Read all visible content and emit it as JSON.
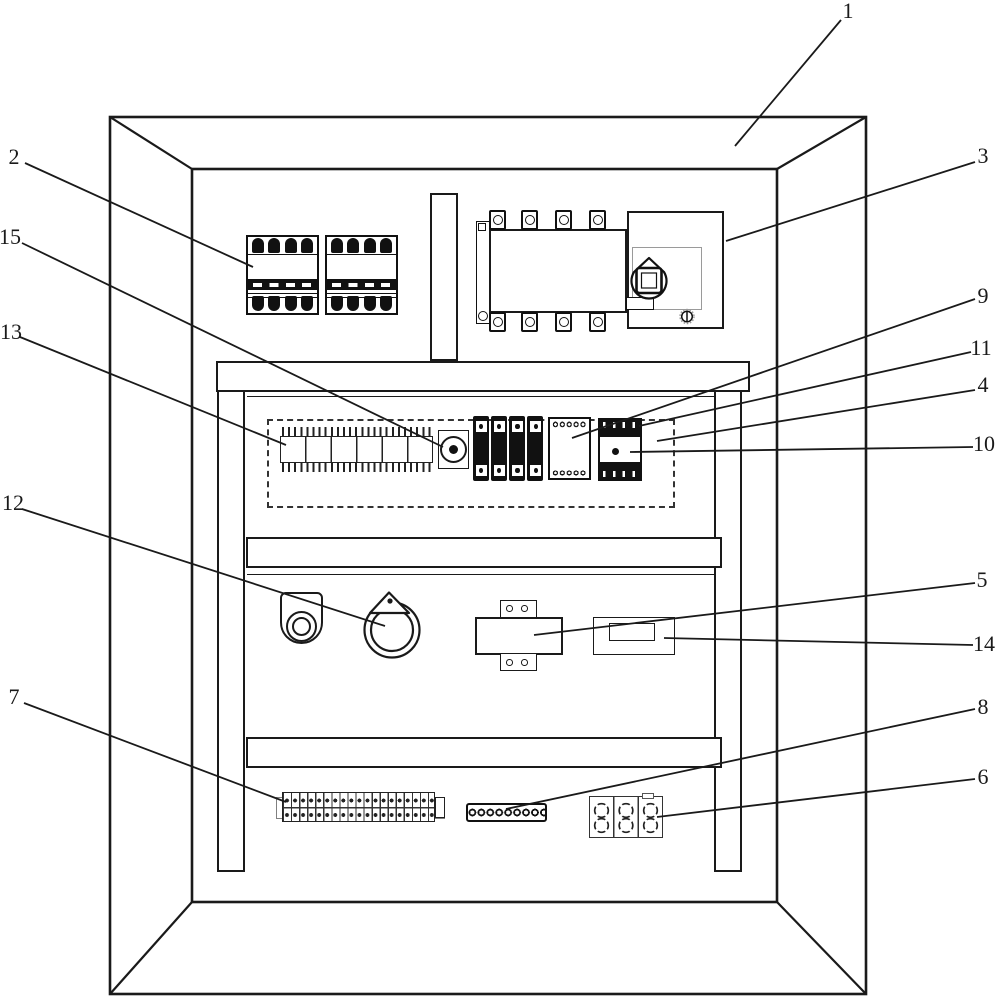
{
  "figure": {
    "callouts": [
      {
        "num": "1"
      },
      {
        "num": "2"
      },
      {
        "num": "3"
      },
      {
        "num": "4"
      },
      {
        "num": "5"
      },
      {
        "num": "6"
      },
      {
        "num": "7"
      },
      {
        "num": "8"
      },
      {
        "num": "9"
      },
      {
        "num": "10"
      },
      {
        "num": "11"
      },
      {
        "num": "12"
      },
      {
        "num": "13"
      },
      {
        "num": "14"
      },
      {
        "num": "15"
      }
    ],
    "colors": {
      "line": "#1a1a1a",
      "paper": "#ffffff",
      "component_dark": "#111111"
    }
  }
}
